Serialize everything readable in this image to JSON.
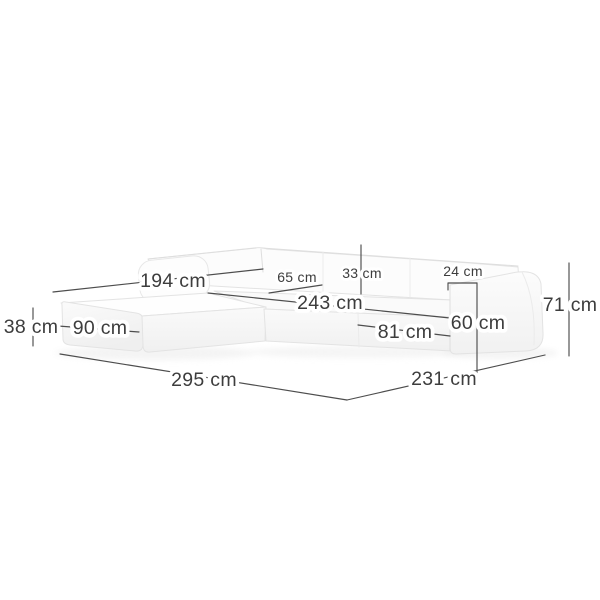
{
  "diagram": {
    "title": "Corner sofa with chaise - dimension diagram",
    "unit": "cm",
    "colors": {
      "background": "#ffffff",
      "dimension_line": "#4d4d4d",
      "label_text": "#3d3d3d",
      "label_halo": "#ffffff",
      "sofa_fill": "#fbfbfb",
      "sofa_edge": "#e3e3e3"
    },
    "dimensions": {
      "chaise_depth": {
        "label": "194 cm",
        "value": 194
      },
      "corner_seat_depth": {
        "label": "65 cm",
        "value": 65
      },
      "backrest_height": {
        "label": "33 cm",
        "value": 33
      },
      "armrest_width": {
        "label": "24 cm",
        "value": 24
      },
      "inner_width": {
        "label": "243 cm",
        "value": 243
      },
      "chaise_width": {
        "label": "90 cm",
        "value": 90
      },
      "seat_height": {
        "label": "38 cm",
        "value": 38
      },
      "seat_width": {
        "label": "81 cm",
        "value": 81
      },
      "armrest_height": {
        "label": "60 cm",
        "value": 60
      },
      "total_height": {
        "label": "71 cm",
        "value": 71
      },
      "total_width": {
        "label": "295 cm",
        "value": 295
      },
      "total_depth": {
        "label": "231 cm",
        "value": 231
      }
    }
  }
}
